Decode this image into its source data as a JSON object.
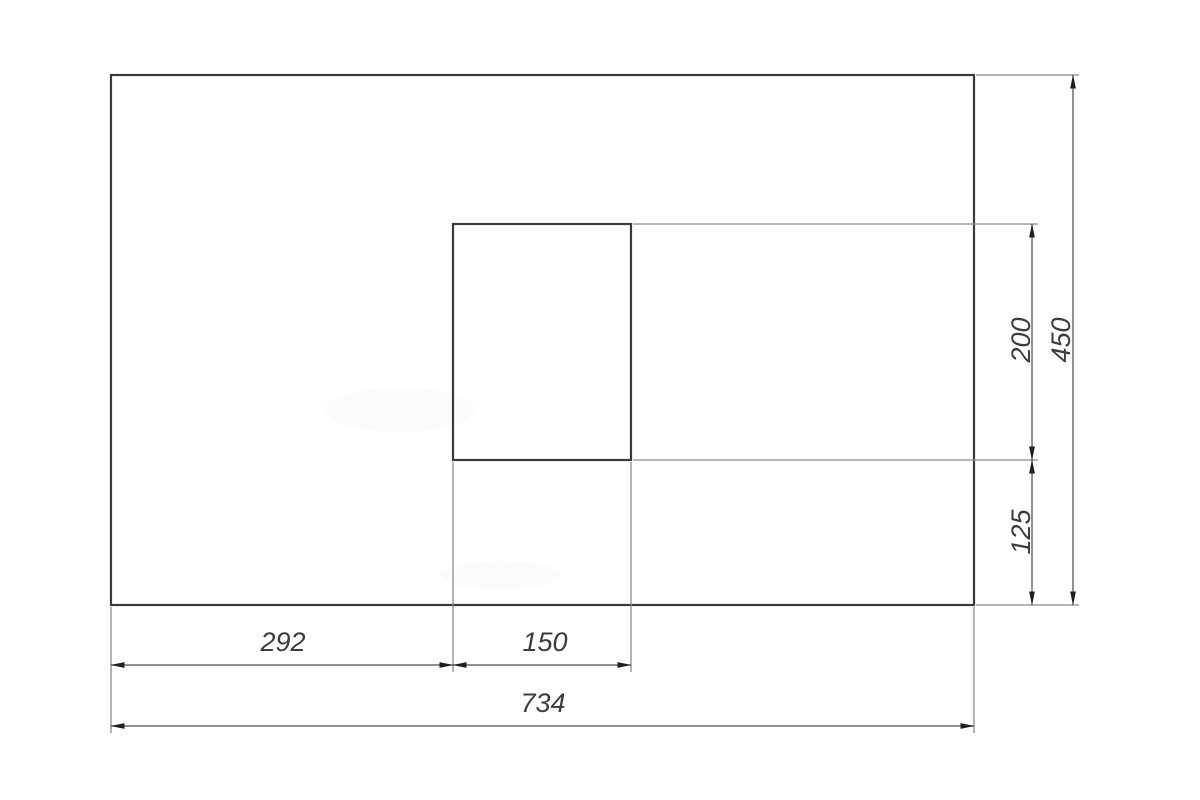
{
  "diagram": {
    "type": "technical-dimension-drawing",
    "description": "Outer rectangular panel with inner rectangular cutout and dimension chains",
    "dimensions": {
      "offset_left": {
        "label": "292",
        "value": 292,
        "edge": "bottom",
        "role": "distance from left edge to cutout"
      },
      "cutout_width": {
        "label": "150",
        "value": 150,
        "edge": "bottom",
        "role": "cutout width"
      },
      "total_width": {
        "label": "734",
        "value": 734,
        "edge": "bottom",
        "role": "overall width"
      },
      "cutout_height": {
        "label": "200",
        "value": 200,
        "edge": "right",
        "role": "cutout height"
      },
      "bottom_offset": {
        "label": "125",
        "value": 125,
        "edge": "right",
        "role": "distance from bottom edge to cutout"
      },
      "total_height": {
        "label": "450",
        "value": 450,
        "edge": "right",
        "role": "overall height"
      }
    },
    "colors": {
      "background": "#ffffff",
      "outline": "#3a3a3a",
      "dimension_line": "#4e4e4e",
      "extension_line": "#8b8b8b",
      "arrow": "#1f1f1f",
      "text": "#3c3c3c"
    }
  }
}
